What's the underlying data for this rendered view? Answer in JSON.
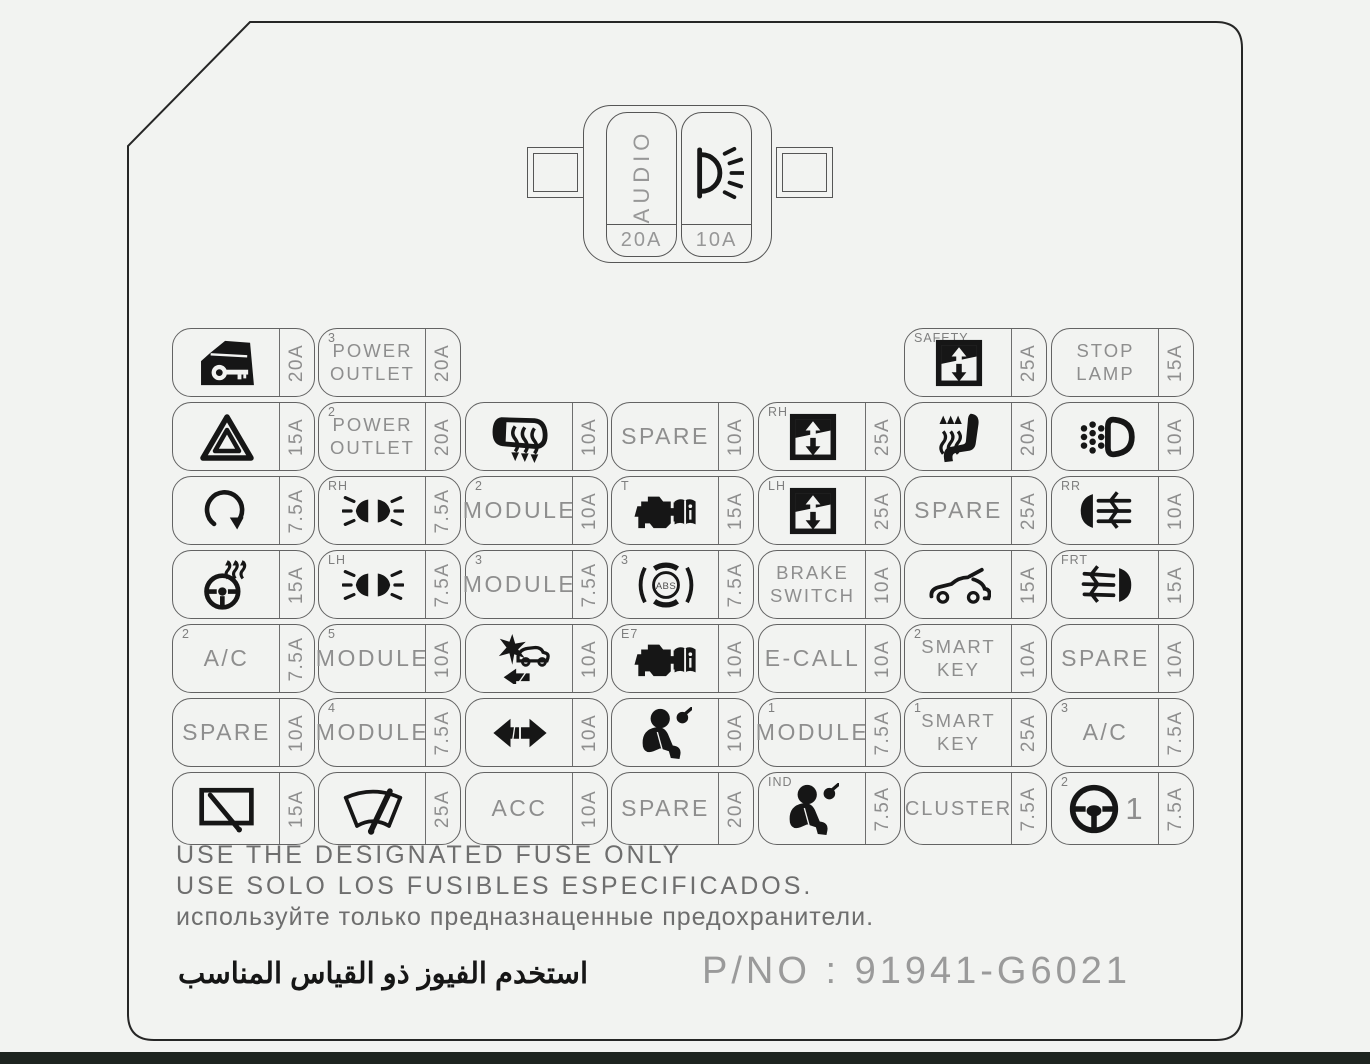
{
  "panel": {
    "warnings": [
      "USE THE DESIGNATED FUSE ONLY",
      "USE SOLO LOS FUSIBLES ESPECIFICADOS.",
      "используйте только предназнаценные предохранители.",
      "استخدم الفيوز ذو القياس المناسب"
    ],
    "part_number_label": "P/NO : 91941-G6021"
  },
  "top_fuse": {
    "slots": [
      {
        "label": "AUDIO",
        "icon": null,
        "amp": "20A"
      },
      {
        "label": null,
        "icon": "lamp-icon",
        "amp": "10A"
      }
    ]
  },
  "grid": {
    "rows": [
      [
        {
          "col": 1,
          "icon": "door-lock-icon",
          "amp": "20A"
        },
        {
          "col": 2,
          "corner": "3",
          "lines": [
            "POWER",
            "OUTLET"
          ],
          "amp": "20A"
        },
        {
          "col": 6,
          "corner": "SAFETY",
          "icon": "window-icon",
          "amp": "25A"
        },
        {
          "col": 7,
          "lines": [
            "STOP",
            "LAMP"
          ],
          "amp": "15A"
        }
      ],
      [
        {
          "col": 1,
          "icon": "hazard-icon",
          "amp": "15A"
        },
        {
          "col": 2,
          "corner": "2",
          "lines": [
            "POWER",
            "OUTLET"
          ],
          "amp": "20A"
        },
        {
          "col": 3,
          "icon": "mirror-heat-icon",
          "amp": "10A"
        },
        {
          "col": 4,
          "lines": [
            "SPARE"
          ],
          "amp": "10A"
        },
        {
          "col": 5,
          "corner": "RH",
          "icon": "window-icon",
          "amp": "25A"
        },
        {
          "col": 6,
          "icon": "seat-heat-icon",
          "amp": "20A"
        },
        {
          "col": 7,
          "icon": "drl-icon",
          "amp": "10A"
        }
      ],
      [
        {
          "col": 1,
          "icon": "rotate-icon",
          "amp": "7.5A"
        },
        {
          "col": 2,
          "corner": "RH",
          "icon": "headlamp-icon",
          "amp": "7.5A"
        },
        {
          "col": 3,
          "corner": "2",
          "lines": [
            "MODULE"
          ],
          "amp": "10A"
        },
        {
          "col": 4,
          "corner": "T",
          "icon": "engine-book-icon",
          "amp": "15A"
        },
        {
          "col": 5,
          "corner": "LH",
          "icon": "window-icon",
          "amp": "25A"
        },
        {
          "col": 6,
          "lines": [
            "SPARE"
          ],
          "amp": "25A"
        },
        {
          "col": 7,
          "corner": "RR",
          "icon": "rear-fog-icon",
          "amp": "10A"
        }
      ],
      [
        {
          "col": 1,
          "icon": "steering-heat-icon",
          "amp": "15A"
        },
        {
          "col": 2,
          "corner": "LH",
          "icon": "headlamp-icon",
          "amp": "7.5A"
        },
        {
          "col": 3,
          "corner": "3",
          "lines": [
            "MODULE"
          ],
          "amp": "7.5A"
        },
        {
          "col": 4,
          "corner": "3",
          "icon": "abs-icon",
          "amp": "7.5A"
        },
        {
          "col": 5,
          "lines": [
            "BRAKE",
            "SWITCH"
          ],
          "amp": "10A"
        },
        {
          "col": 6,
          "icon": "car-hood-icon",
          "amp": "15A"
        },
        {
          "col": 7,
          "corner": "FRT",
          "icon": "front-fog-icon",
          "amp": "15A"
        }
      ],
      [
        {
          "col": 1,
          "corner": "2",
          "lines": [
            "A/C"
          ],
          "amp": "7.5A"
        },
        {
          "col": 2,
          "corner": "5",
          "lines": [
            "MODULE"
          ],
          "amp": "10A"
        },
        {
          "col": 3,
          "icon": "collision-icon",
          "amp": "10A"
        },
        {
          "col": 4,
          "corner": "E7",
          "icon": "engine-book-icon",
          "amp": "10A"
        },
        {
          "col": 5,
          "lines": [
            "E-CALL"
          ],
          "amp": "10A"
        },
        {
          "col": 6,
          "corner": "2",
          "lines": [
            "SMART",
            "KEY"
          ],
          "amp": "10A"
        },
        {
          "col": 7,
          "lines": [
            "SPARE"
          ],
          "amp": "10A"
        }
      ],
      [
        {
          "col": 1,
          "lines": [
            "SPARE"
          ],
          "amp": "10A"
        },
        {
          "col": 2,
          "corner": "4",
          "lines": [
            "MODULE"
          ],
          "amp": "7.5A"
        },
        {
          "col": 3,
          "icon": "arrows-icon",
          "amp": "10A"
        },
        {
          "col": 4,
          "icon": "airbag-icon",
          "amp": "10A"
        },
        {
          "col": 5,
          "corner": "1",
          "lines": [
            "MODULE"
          ],
          "amp": "7.5A"
        },
        {
          "col": 6,
          "corner": "1",
          "lines": [
            "SMART",
            "KEY"
          ],
          "amp": "25A"
        },
        {
          "col": 7,
          "corner": "3",
          "lines": [
            "A/C"
          ],
          "amp": "7.5A"
        }
      ],
      [
        {
          "col": 1,
          "icon": "rear-wiper-icon",
          "amp": "15A"
        },
        {
          "col": 2,
          "icon": "front-wiper-icon",
          "amp": "25A"
        },
        {
          "col": 3,
          "lines": [
            "ACC"
          ],
          "amp": "10A"
        },
        {
          "col": 4,
          "lines": [
            "SPARE"
          ],
          "amp": "20A"
        },
        {
          "col": 5,
          "corner": "IND",
          "icon": "airbag-icon",
          "amp": "7.5A"
        },
        {
          "col": 6,
          "lines": [
            "CLUSTER"
          ],
          "amp": "7.5A"
        },
        {
          "col": 7,
          "corner": "2",
          "icon": "steering-icon",
          "suffix": "1",
          "amp": "7.5A"
        }
      ]
    ]
  },
  "colors": {
    "background": "#f2f3f1",
    "panel_line": "#262626",
    "cell_line": "#636363",
    "icon": "#161616",
    "label_text": "#8e8e8e",
    "warning_text": "#6e6e6e",
    "bottom_strip": "#1d241f"
  }
}
